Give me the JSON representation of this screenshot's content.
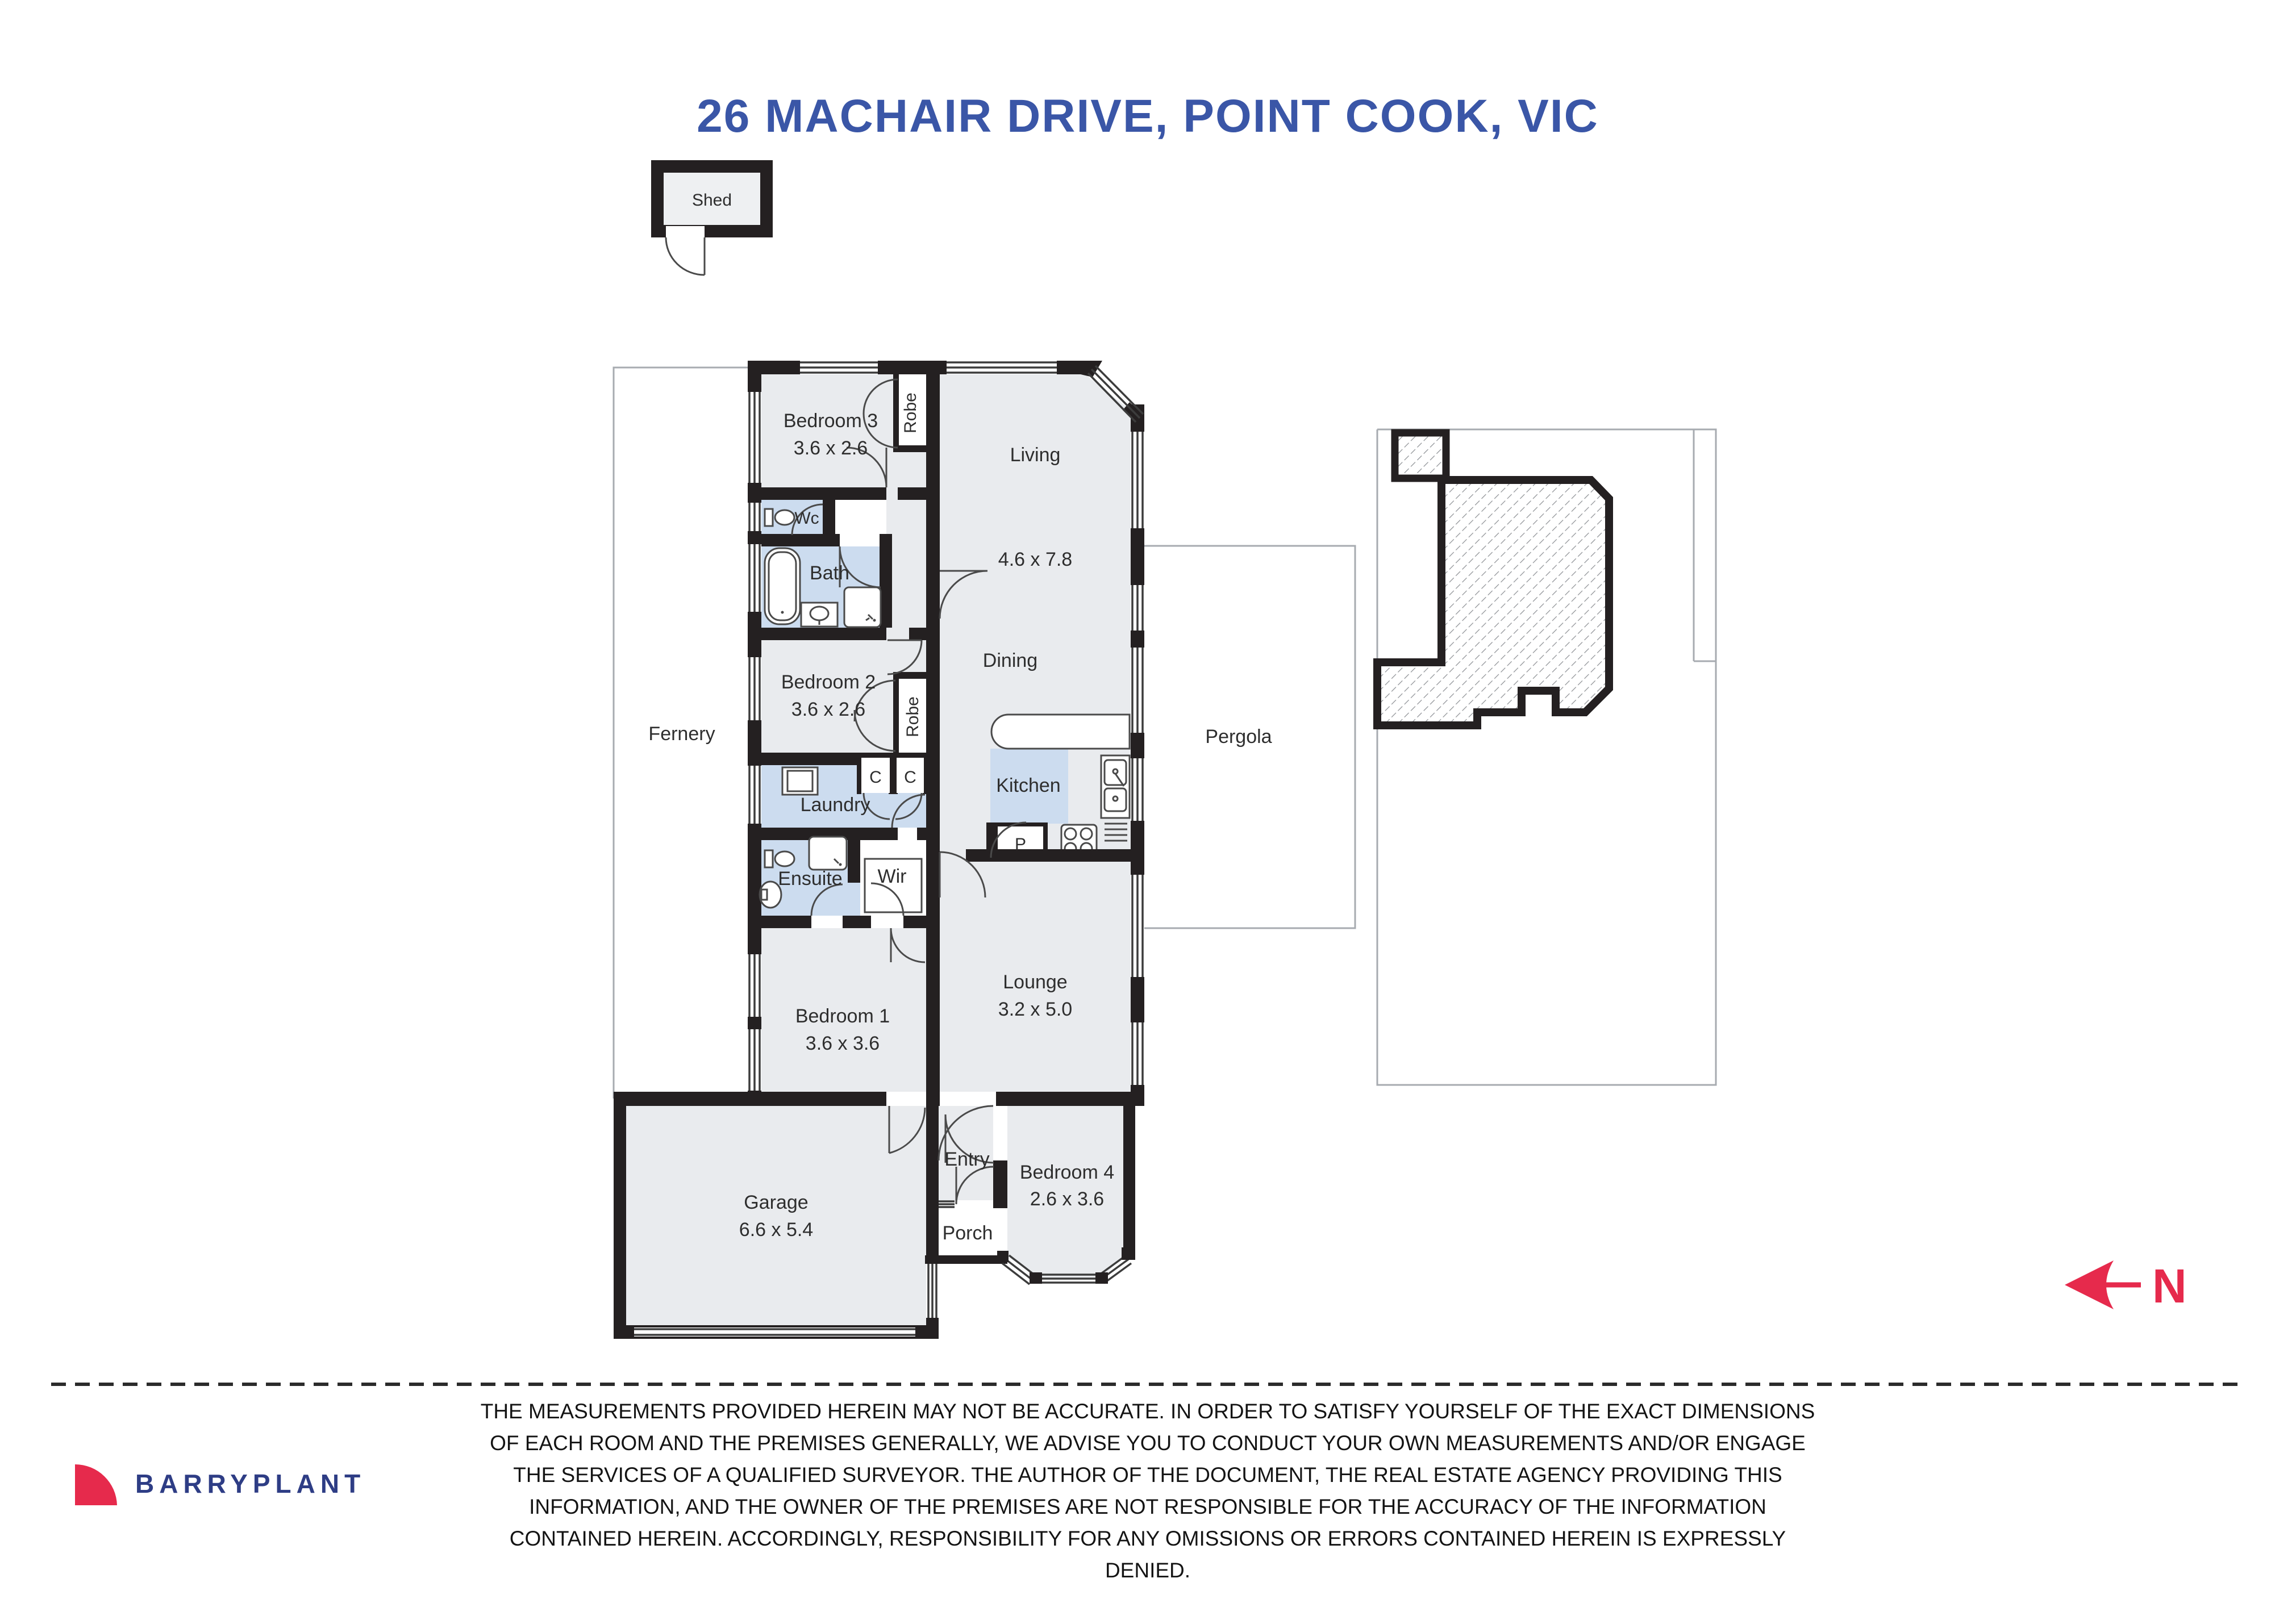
{
  "title": "26 MACHAIR DRIVE, POINT COOK, VIC",
  "colors": {
    "accent": "#3a56a7",
    "wall": "#242021",
    "room": "#e9ebee",
    "wet": "#ccdcef",
    "north": "#e62a4c",
    "brand_navy": "#2e3d85",
    "brand_red": "#e62a4c",
    "line": "#a7abb0",
    "ink": "#2b2b2b"
  },
  "plan": {
    "shed": "Shed",
    "fernery": "Fernery",
    "pergola": "Pergola",
    "north": "N",
    "rooms": {
      "bedroom3": {
        "name": "Bedroom 3",
        "dims": "3.6 x 2.6"
      },
      "living": {
        "name": "Living",
        "dims": "4.6 x 7.8"
      },
      "wc": {
        "name": "Wc"
      },
      "bath": {
        "name": "Bath"
      },
      "bedroom2": {
        "name": "Bedroom 2",
        "dims": "3.6 x 2.6"
      },
      "dining": {
        "name": "Dining"
      },
      "kitchen": {
        "name": "Kitchen"
      },
      "pantry": {
        "name": "P"
      },
      "laundry": {
        "name": "Laundry"
      },
      "closet_left": {
        "name": "C"
      },
      "closet_right": {
        "name": "C"
      },
      "robe_bed3": {
        "name": "Robe"
      },
      "robe_bed2": {
        "name": "Robe"
      },
      "ensuite": {
        "name": "Ensuite"
      },
      "wir": {
        "name": "Wir"
      },
      "bedroom1": {
        "name": "Bedroom 1",
        "dims": "3.6 x 3.6"
      },
      "lounge": {
        "name": "Lounge",
        "dims": "3.2 x 5.0"
      },
      "garage": {
        "name": "Garage",
        "dims": "6.6 x 5.4"
      },
      "entry": {
        "name": "Entry"
      },
      "porch": {
        "name": "Porch"
      },
      "bedroom4": {
        "name": "Bedroom 4",
        "dims": "2.6 x 3.6"
      }
    }
  },
  "footer": {
    "disclaimer_lines": [
      "THE MEASUREMENTS PROVIDED HEREIN MAY NOT BE ACCURATE. IN ORDER TO SATISFY YOURSELF OF THE EXACT DIMENSIONS",
      "OF EACH ROOM AND THE PREMISES GENERALLY, WE ADVISE YOU TO CONDUCT YOUR OWN MEASUREMENTS AND/OR ENGAGE",
      "THE SERVICES OF A QUALIFIED SURVEYOR. THE AUTHOR OF THE DOCUMENT, THE REAL ESTATE AGENCY PROVIDING THIS",
      "INFORMATION, AND THE OWNER OF THE PREMISES ARE NOT RESPONSIBLE FOR THE ACCURACY OF THE INFORMATION",
      "CONTAINED HEREIN. ACCORDINGLY, RESPONSIBILITY FOR ANY OMISSIONS OR ERRORS CONTAINED HEREIN IS EXPRESSLY",
      "DENIED."
    ],
    "brand": "BARRYPLANT"
  }
}
